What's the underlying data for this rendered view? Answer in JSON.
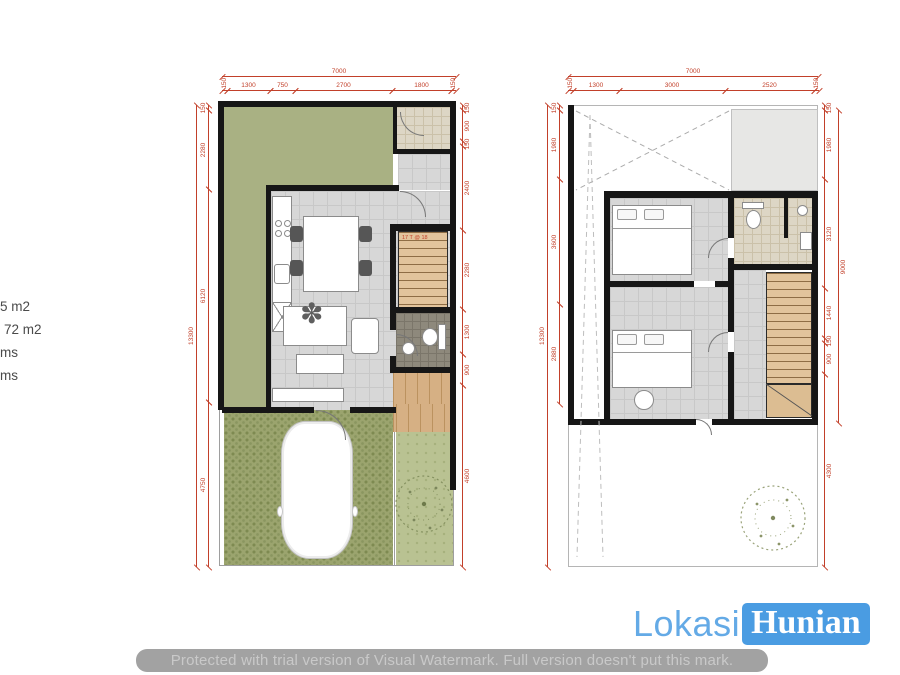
{
  "info_panel": {
    "lines": [
      "5 m2",
      "72 m2",
      "ms",
      "ms"
    ]
  },
  "floor1": {
    "stair_note": "17 T @ 18",
    "dims": {
      "top_total": "7000",
      "top_segments": [
        "150",
        "1300",
        "750",
        "2700",
        "1800",
        "150"
      ],
      "left_total": "13300",
      "left_segments": [
        "150",
        "2280",
        "6120",
        "4750"
      ],
      "right_segments": [
        "150",
        "900",
        "150",
        "2400",
        "2280",
        "1300",
        "900",
        "4600"
      ]
    }
  },
  "floor2": {
    "dims": {
      "top_total": "7000",
      "top_segments": [
        "150",
        "1300",
        "3000",
        "2520",
        "150"
      ],
      "left_total": "13300",
      "left_segments": [
        "150",
        "1980",
        "3600",
        "2880"
      ],
      "right_total": "9000",
      "right_segments": [
        "150",
        "1980",
        "3120",
        "1440",
        "150",
        "900",
        "4300"
      ]
    }
  },
  "logo": {
    "part1": "Lokasi",
    "part2": "Hunian",
    "blue": "#4a9ce2"
  },
  "watermark": {
    "text": "Protected with trial version of Visual Watermark. Full version doesn't put this mark."
  },
  "colors": {
    "dimension_red": "#c2402a",
    "garden_green": "#a9b183",
    "paver_green": "#9ba46e",
    "grass_green": "#b9c292",
    "floor_gray": "#d7d7d7",
    "wood": "#d6b084",
    "wall_black": "#161616",
    "logo_blue": "#4a9ce2"
  }
}
